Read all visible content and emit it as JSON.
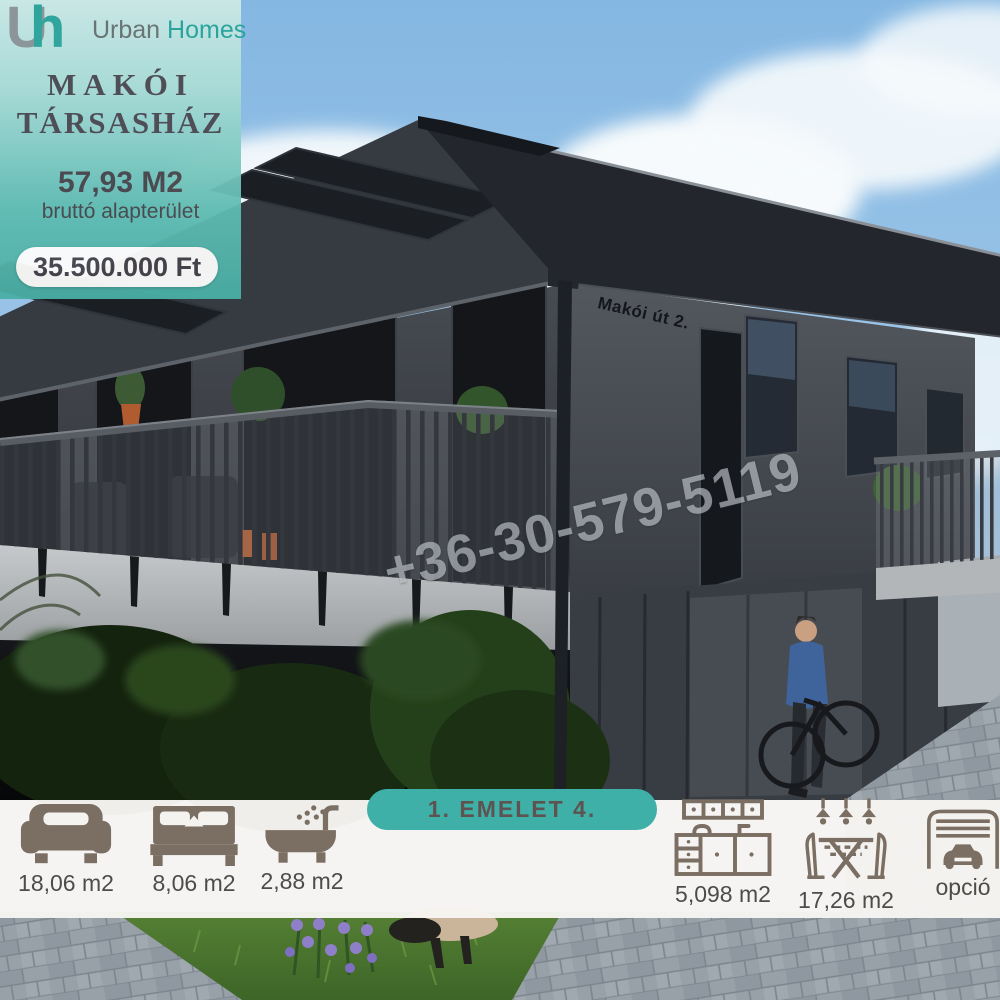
{
  "brand": {
    "logo_u": "U",
    "logo_h": "h",
    "name_primary": "Urban",
    "name_secondary": "Homes"
  },
  "listing": {
    "title_line1": "MAKÓI",
    "title_line2": "TÁRSASHÁZ",
    "area_value": "57,93 M2",
    "area_label": "bruttó alapterület",
    "price": "35.500.000 Ft"
  },
  "building_sign": "Makói út 2.",
  "watermark_phone": "+36-30-579-5119",
  "floor_badge": "1. EMELET 4.",
  "rooms": [
    {
      "icon": "sofa-icon",
      "label": "18,06 m2"
    },
    {
      "icon": "bed-icon",
      "label": "8,06 m2"
    },
    {
      "icon": "bath-icon",
      "label": "2,88 m2"
    },
    {
      "icon": "kitchen-icon",
      "label": "5,098 m2"
    },
    {
      "icon": "dining-icon",
      "label": "17,26 m2"
    },
    {
      "icon": "garage-icon",
      "label": "opció"
    }
  ],
  "colors": {
    "accent_teal": "#3fb0a7",
    "panel_teal_light": "#cdeae6",
    "panel_teal_dark": "#49afa6",
    "icon_brown": "#7b6e62",
    "label_grey": "#4e4c4a",
    "title_grey": "#4c4950",
    "price_text": "#45424a",
    "sky_blue": "#8fc0e6",
    "roof_dark": "#272a30",
    "wall_grey": "#43474d"
  }
}
